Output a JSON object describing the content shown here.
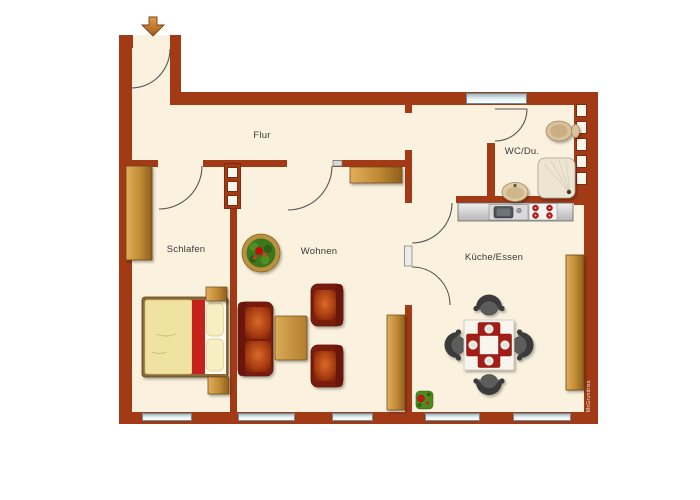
{
  "plan_type": "apartment-floor-plan",
  "rooms": [
    {
      "id": "flur",
      "label": "Flur"
    },
    {
      "id": "schlafen",
      "label": "Schlafen"
    },
    {
      "id": "wohnen",
      "label": "Wohnen"
    },
    {
      "id": "kueche",
      "label": "Küche/Essen"
    },
    {
      "id": "wc",
      "label": "WC/Du."
    }
  ],
  "watermark": "McGrundriss",
  "counts": {
    "windows": 6,
    "door_openings": 6
  },
  "colors": {
    "wall": "#A23A16",
    "floor": "#FAF2DE",
    "window_blue": "#BCD2D9",
    "wood": "#C08A3A",
    "upholstery_red": "#7A1D0C",
    "cushion_orange": "#C75A1E",
    "bed_stripe_red": "#C5231D",
    "placemat_red": "#A41E17",
    "chair_gray": "#5C5C5C",
    "plant_green": "#3E7A1E",
    "flower_red": "#CC1515",
    "arrow_orange": "#C77A33",
    "counter_gray": "#C9C9C9"
  },
  "furniture_icons": [
    "entrance-arrow-icon",
    "wardrobe",
    "double-bed",
    "nightstand",
    "potted-plant",
    "sofa",
    "coffee-table",
    "armchair",
    "sideboard",
    "kitchen-counter",
    "kitchen-sink",
    "stove",
    "tall-cabinet",
    "dining-table",
    "dining-chair",
    "placemat",
    "small-plant",
    "toilet",
    "shower",
    "wash-basin",
    "installation-shaft",
    "window",
    "door-swing"
  ]
}
